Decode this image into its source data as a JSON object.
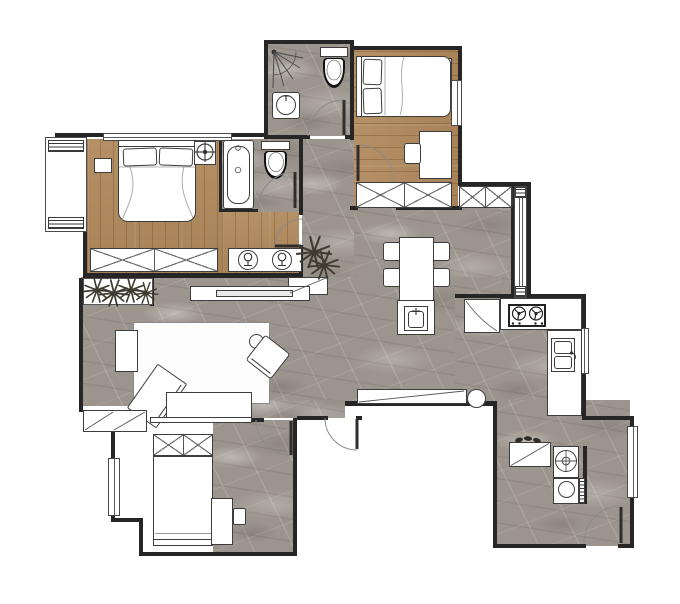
{
  "meta": {
    "type": "apartment-floor-plan",
    "view": "top-down interior design rendering",
    "visible_text": []
  },
  "palette": {
    "wood": "#b1895c",
    "marble": "#9c958d",
    "wall": "#262626",
    "line": "#3d3d3d",
    "furniture_fill": "#ffffff",
    "plant": "#3f3b31",
    "paper": "#ffffff"
  },
  "rooms": [
    {
      "id": "master-bedroom",
      "floor": "wood",
      "furniture": [
        "double-bed",
        "two-pillows",
        "nightstand",
        "ceiling-fan-symbol",
        "wardrobe-with-x-panels",
        "double-sink-vanity",
        "bay-window",
        "top-window"
      ]
    },
    {
      "id": "master-bathroom",
      "floor": "marble",
      "furniture": [
        "bathtub",
        "toilet",
        "door-swing"
      ]
    },
    {
      "id": "top-bathroom",
      "floor": "marble",
      "furniture": [
        "corner-shower-spray",
        "toilet",
        "washbasin",
        "door-swing"
      ]
    },
    {
      "id": "bedroom-2",
      "floor": "wood",
      "furniture": [
        "double-bed",
        "two-pillows",
        "desk",
        "chair",
        "wardrobe-with-x-panels",
        "radiator",
        "window",
        "door-swing"
      ]
    },
    {
      "id": "dining-area",
      "floor": "marble",
      "furniture": [
        "dining-table",
        "four-chairs",
        "island-cabinet-with-basin",
        "sideboard-with-x-panels",
        "plant",
        "tall-window-column"
      ]
    },
    {
      "id": "kitchen",
      "floor": "marble",
      "furniture": [
        "fridge-with-door-swing",
        "l-shaped-counter",
        "two-burner-cooktop",
        "double-sink",
        "window"
      ]
    },
    {
      "id": "living-room",
      "floor": "marble",
      "furniture": [
        "area-rug",
        "chaise-lounge",
        "rotated-armchair",
        "round-side-table",
        "side-table",
        "tv-console",
        "tv",
        "bench-cabinet",
        "planter-row",
        "window-ledge-cabinet",
        "round-column",
        "balcony-door-swing"
      ]
    },
    {
      "id": "bedroom-3",
      "floor": "white-with-marble-patch",
      "furniture": [
        "single-bed",
        "wardrobe-with-x-panels",
        "desk",
        "chair",
        "window",
        "door-swing"
      ]
    },
    {
      "id": "entry",
      "floor": "marble",
      "furniture": [
        "shoe-cabinet",
        "shoes",
        "round-wash-basin",
        "washing-machine",
        "entry-door-swing",
        "window"
      ]
    }
  ],
  "counts": {
    "bedrooms": 3,
    "bathrooms": 2,
    "door_swings": 7,
    "windows": 8,
    "dining_chairs": 4,
    "cooktop_burners": 2,
    "vanity_sinks": 2,
    "plants": 6
  }
}
